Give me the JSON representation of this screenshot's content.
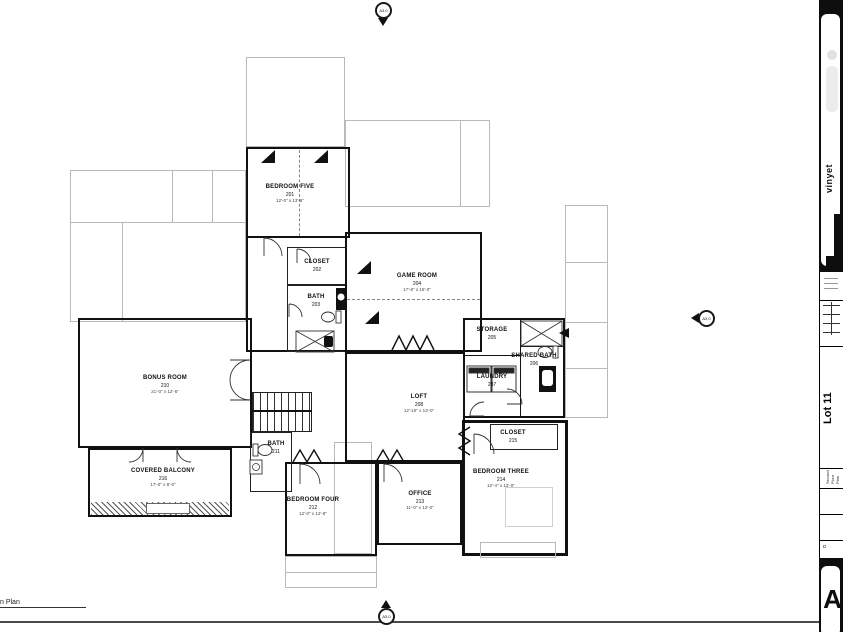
{
  "sheet": {
    "plan_caption": "n Plan",
    "border_color": "#4a4a4a"
  },
  "markers": {
    "label": "A3.0"
  },
  "rooms": [
    {
      "name": "BEDROOM FIVE",
      "number": "201",
      "dims": "12'-0\" x 13'-6\""
    },
    {
      "name": "CLOSET",
      "number": "202",
      "dims": ""
    },
    {
      "name": "BATH",
      "number": "203",
      "dims": ""
    },
    {
      "name": "GAME ROOM",
      "number": "204",
      "dims": "17'-8\" x 15'-0\""
    },
    {
      "name": "STORAGE",
      "number": "205",
      "dims": ""
    },
    {
      "name": "SHARED BATH",
      "number": "206",
      "dims": ""
    },
    {
      "name": "LAUNDRY",
      "number": "207",
      "dims": ""
    },
    {
      "name": "LOFT",
      "number": "208",
      "dims": "12'-10\" x 13'-0\""
    },
    {
      "name": "BONUS ROOM",
      "number": "210",
      "dims": "21'-0\" x 12'-6\""
    },
    {
      "name": "BATH",
      "number": "211",
      "dims": ""
    },
    {
      "name": "BEDROOM FOUR",
      "number": "212",
      "dims": "12'-0\" x 12'-8\""
    },
    {
      "name": "OFFICE",
      "number": "213",
      "dims": "11'-0\" x 12'-0\""
    },
    {
      "name": "BEDROOM THREE",
      "number": "214",
      "dims": "12'-4\" x 13'-0\""
    },
    {
      "name": "CLOSET",
      "number": "215",
      "dims": ""
    },
    {
      "name": "COVERED BALCONY",
      "number": "216",
      "dims": "17'-0\" x 8'-0\""
    }
  ],
  "titleblock": {
    "brand": "vinyet",
    "lot": "Lot 11",
    "sheet_title": "Second Floor Plan",
    "date_label": "D",
    "sheet_letter": "A",
    "strip_bg": "#0e0e0e"
  }
}
